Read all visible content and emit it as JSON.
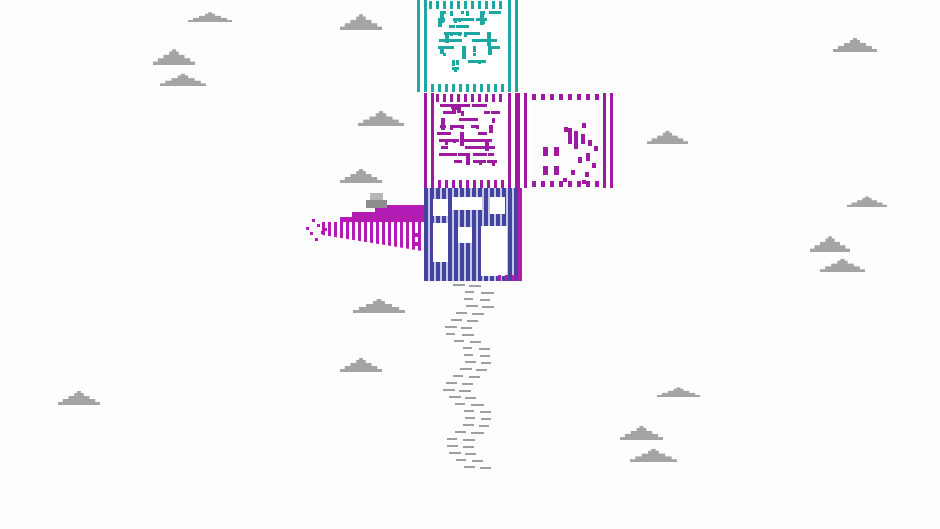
{
  "meta": {
    "description": "Pixel-art game frame: a rocket-like tower of dithered striped blocks (teal, magenta, blue with white windows) flying among gray pixel clouds, with a purple comb wing, gray block, spray particles and a dashed gray smoke trail below",
    "viewport": {
      "width": 940,
      "height": 529
    }
  },
  "palette": {
    "background": "#fdfdfe",
    "teal": "#1ea7a3",
    "magenta": "#9e1ba1",
    "magenta_bright": "#b21cb5",
    "blue": "#4343a0",
    "blue_gap": "#c7c7e8",
    "cloud_gray": "#a4a4a4",
    "block_gray_light": "#b6b6b6",
    "block_gray_dark": "#8d8d8d",
    "trail_gray": "#9ba0a6"
  },
  "clouds": [
    {
      "x": 188,
      "y": 7,
      "w": 44,
      "h": 11
    },
    {
      "x": 340,
      "y": 12,
      "w": 42,
      "h": 18
    },
    {
      "x": 153,
      "y": 47,
      "w": 42,
      "h": 18
    },
    {
      "x": 160,
      "y": 71,
      "w": 46,
      "h": 14
    },
    {
      "x": 833,
      "y": 36,
      "w": 44,
      "h": 16
    },
    {
      "x": 358,
      "y": 109,
      "w": 46,
      "h": 17
    },
    {
      "x": 647,
      "y": 129,
      "w": 41,
      "h": 15
    },
    {
      "x": 340,
      "y": 167,
      "w": 42,
      "h": 16
    },
    {
      "x": 847,
      "y": 192,
      "w": 40,
      "h": 12
    },
    {
      "x": 810,
      "y": 234,
      "w": 40,
      "h": 18
    },
    {
      "x": 820,
      "y": 257,
      "w": 45,
      "h": 15
    },
    {
      "x": 353,
      "y": 297,
      "w": 52,
      "h": 16
    },
    {
      "x": 340,
      "y": 356,
      "w": 42,
      "h": 16
    },
    {
      "x": 58,
      "y": 389,
      "w": 42,
      "h": 16
    },
    {
      "x": 657,
      "y": 382,
      "w": 43,
      "h": 11
    },
    {
      "x": 620,
      "y": 424,
      "w": 43,
      "h": 16
    },
    {
      "x": 630,
      "y": 447,
      "w": 47,
      "h": 15
    }
  ],
  "tower": {
    "teal_box": {
      "x": 417,
      "y": 0,
      "w": 101,
      "h": 92,
      "scatter": {
        "x": 437,
        "y": 11,
        "w": 66,
        "h": 70,
        "count": 55,
        "seed": 11
      }
    },
    "magenta_box": {
      "x": 424,
      "y": 93,
      "w": 94,
      "h": 95,
      "scatter": {
        "x": 437,
        "y": 104,
        "w": 68,
        "h": 72,
        "count": 68,
        "seed": 23
      }
    },
    "outline_box": {
      "x": 517,
      "y": 93,
      "w": 100,
      "h": 95,
      "marks": [
        [
          568,
          128,
          4,
          16
        ],
        [
          574,
          131,
          4,
          18
        ],
        [
          564,
          127,
          4,
          5
        ],
        [
          582,
          123,
          4,
          5
        ],
        [
          581,
          134,
          4,
          10
        ],
        [
          588,
          140,
          4,
          6
        ],
        [
          594,
          146,
          4,
          5
        ],
        [
          586,
          153,
          4,
          8
        ],
        [
          578,
          157,
          4,
          6
        ],
        [
          592,
          163,
          4,
          5
        ],
        [
          543,
          147,
          5,
          9
        ],
        [
          554,
          147,
          5,
          9
        ],
        [
          543,
          166,
          5,
          9
        ],
        [
          554,
          166,
          5,
          9
        ],
        [
          571,
          170,
          4,
          5
        ],
        [
          585,
          172,
          4,
          5
        ],
        [
          563,
          178,
          4,
          4
        ],
        [
          582,
          180,
          4,
          4
        ]
      ]
    },
    "blue_box": {
      "x": 424,
      "y": 183,
      "w": 94,
      "h": 98,
      "windows": [
        [
          433,
          199,
          15,
          17
        ],
        [
          433,
          223,
          15,
          39
        ],
        [
          452,
          197,
          30,
          13
        ],
        [
          458,
          227,
          14,
          16
        ],
        [
          490,
          197,
          15,
          17
        ],
        [
          481,
          226,
          26,
          50
        ]
      ]
    }
  },
  "accents": {
    "right_edge": [
      518,
      183,
      4,
      98
    ],
    "bottom_right_comb": [
      498,
      275,
      24,
      6
    ],
    "left_dashes": [
      [
        415,
        233,
        6,
        4
      ],
      [
        415,
        242,
        6,
        4
      ]
    ]
  },
  "wing": {
    "gray_block_top": [
      370,
      193,
      13,
      7
    ],
    "gray_block_bottom": [
      366,
      200,
      21,
      8
    ],
    "solid": [
      [
        375,
        205,
        52,
        17
      ],
      [
        352,
        212,
        23,
        10
      ],
      [
        340,
        217,
        12,
        5
      ]
    ],
    "comb": {
      "x": 322,
      "y": 222,
      "w": 106,
      "left_drop": 13,
      "right_drop": 30
    },
    "particles": [
      [
        306,
        227
      ],
      [
        312,
        219
      ],
      [
        310,
        232
      ],
      [
        317,
        224
      ],
      [
        321,
        231
      ],
      [
        315,
        238
      ],
      [
        324,
        228
      ]
    ]
  },
  "trail": {
    "y_start": 284,
    "y_end": 466,
    "row_step": 7,
    "center_x": 468,
    "sway": 10,
    "dash_h": 2,
    "seed": 7
  }
}
